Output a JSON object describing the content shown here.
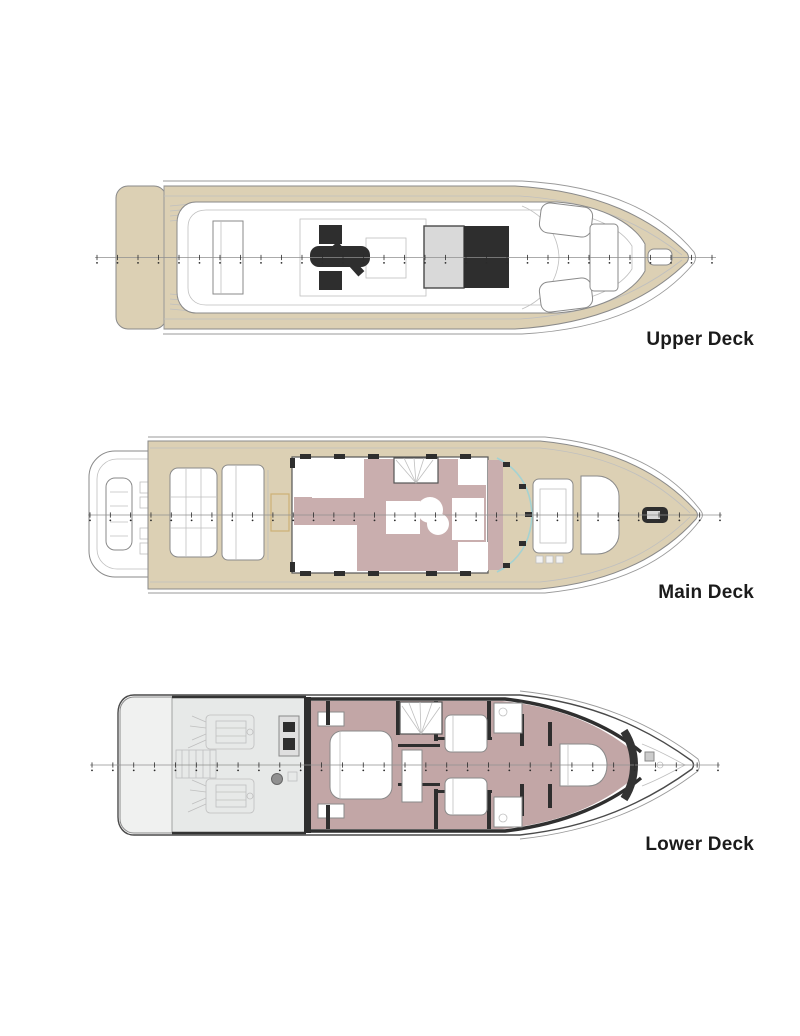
{
  "figure": {
    "type": "yacht-deck-plans",
    "background": "#ffffff"
  },
  "decks": [
    {
      "id": "upper",
      "label": "Upper Deck"
    },
    {
      "id": "main",
      "label": "Main Deck"
    },
    {
      "id": "lower",
      "label": "Lower Deck"
    }
  ],
  "colors": {
    "hull_tan": "#dcd0b4",
    "floor_mauve_main": "#c9aeae",
    "floor_mauve_lower": "#c2a6a6",
    "furniture_dark": "#2e2e2e",
    "pad_light": "#d9d9d9",
    "platform_grey": "#f0f1f0",
    "engine_grey": "#e7e9e8",
    "outline_grey": "#8a8a8a",
    "windshield_teal": "#a4d2d2",
    "hatch_beige": "#cdb176",
    "label_text": "#1b1b1b"
  }
}
